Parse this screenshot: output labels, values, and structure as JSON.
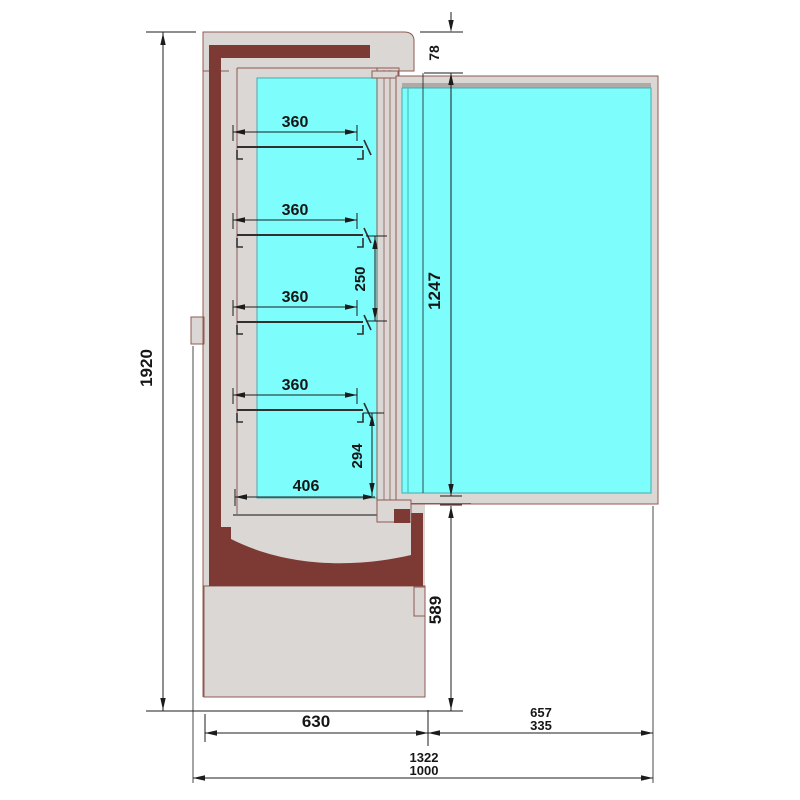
{
  "drawing": {
    "title": "refrigerated-display-cabinet-side-section",
    "view": "side section with glass door open 90 degrees"
  },
  "colors": {
    "cabinet_fill": "#dbd7d4",
    "outline": "#8f5a52",
    "insulation": "#7d3a35",
    "glass": "#7efdfd",
    "glass_edge": "#4aa9ab",
    "dimension_ink": "#1c1c1c",
    "shelf_ink": "#303030",
    "shadow": "#aeaaa8",
    "background": "#ffffff"
  },
  "dim": {
    "height_overall": "1920",
    "door_top_offset": "78",
    "door_glass_height": "1247",
    "shelf_width": [
      "360",
      "360",
      "360",
      "360"
    ],
    "shelf_spacing": "250",
    "lowest_shelf_space": "294",
    "interior_depth": "406",
    "base_front_height": "589",
    "base_depth": "630",
    "door_open_projection": [
      "657",
      "335"
    ],
    "overall_depth": [
      "1322",
      "1000"
    ]
  }
}
